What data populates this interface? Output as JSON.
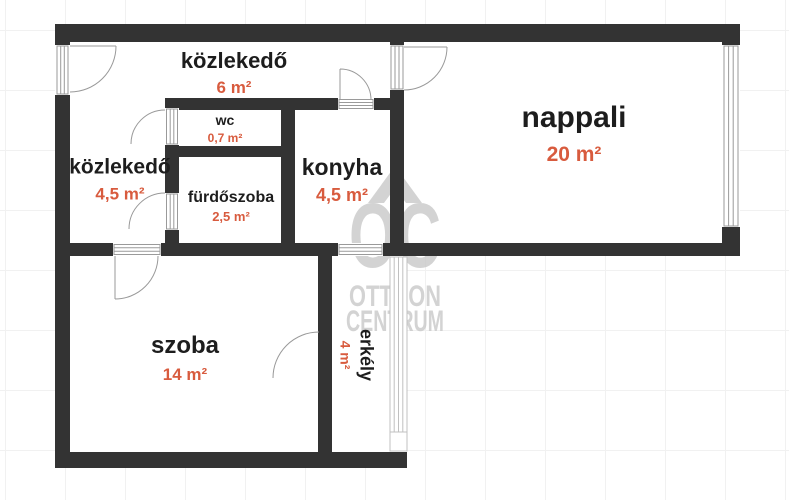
{
  "title": "apartment floor plan",
  "rooms": {
    "hall_top": {
      "name": "közlekedő",
      "area": "6 m²"
    },
    "hall_left": {
      "name": "közlekedő",
      "area": "4,5 m²"
    },
    "wc": {
      "name": "wc",
      "area": "0,7 m²"
    },
    "bathroom": {
      "name": "fürdőszoba",
      "area": "2,5 m²"
    },
    "kitchen": {
      "name": "konyha",
      "area": "4,5 m²"
    },
    "living_room": {
      "name": "nappali",
      "area": "20 m²"
    },
    "room": {
      "name": "szoba",
      "area": "14 m²"
    },
    "balcony": {
      "name": "erkély",
      "area": "4 m²"
    }
  },
  "watermark": {
    "logo": "OC",
    "line1": "OTTHON",
    "line2": "CENTRUM"
  },
  "colors": {
    "wall": "#333333",
    "room_name_text": "#1d1d1d",
    "room_area_text": "#d85b3e",
    "watermark": "#c9c9c9",
    "door_line": "#999999",
    "grid_line": "#f1f1f1"
  }
}
